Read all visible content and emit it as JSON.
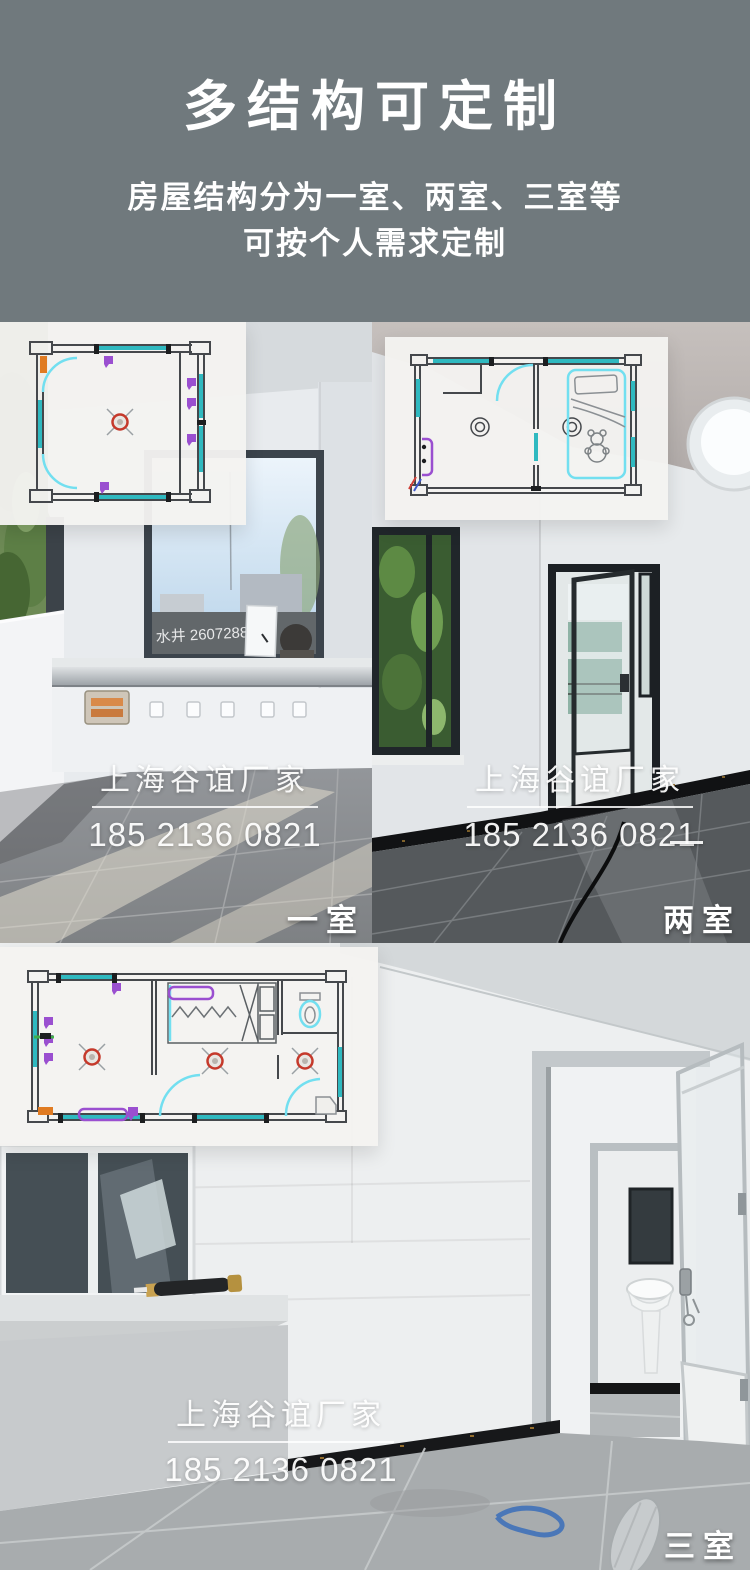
{
  "header": {
    "title": "多结构可定制",
    "subtitle_line1": "房屋结构分为一室、两室、三室等",
    "subtitle_line2": "可按个人需求定制"
  },
  "watermark": {
    "name": "上海谷谊厂家",
    "phone": "185 2136 0821"
  },
  "photos": [
    {
      "label": "一室",
      "graffiti": "水井 2607288",
      "plan_icon": "one-room-floor-plan-icon"
    },
    {
      "label": "两室",
      "plan_icon": "two-room-floor-plan-icon"
    },
    {
      "label": "三室",
      "plan_icon": "three-room-floor-plan-icon"
    }
  ],
  "colors": {
    "header_bg": "#70797d",
    "header_text": "#ffffff",
    "plan_bg": "rgba(244,243,240,0.96)",
    "plan_wall": "#45484c",
    "plan_window": "#2fb9c0",
    "plan_door_arc": "#72dff0",
    "plan_outlet": "#9a4fd0",
    "plan_ceiling_light": "#c5392b",
    "plan_accent_orange": "#e07b22",
    "watermark_text": "#ffffff"
  }
}
